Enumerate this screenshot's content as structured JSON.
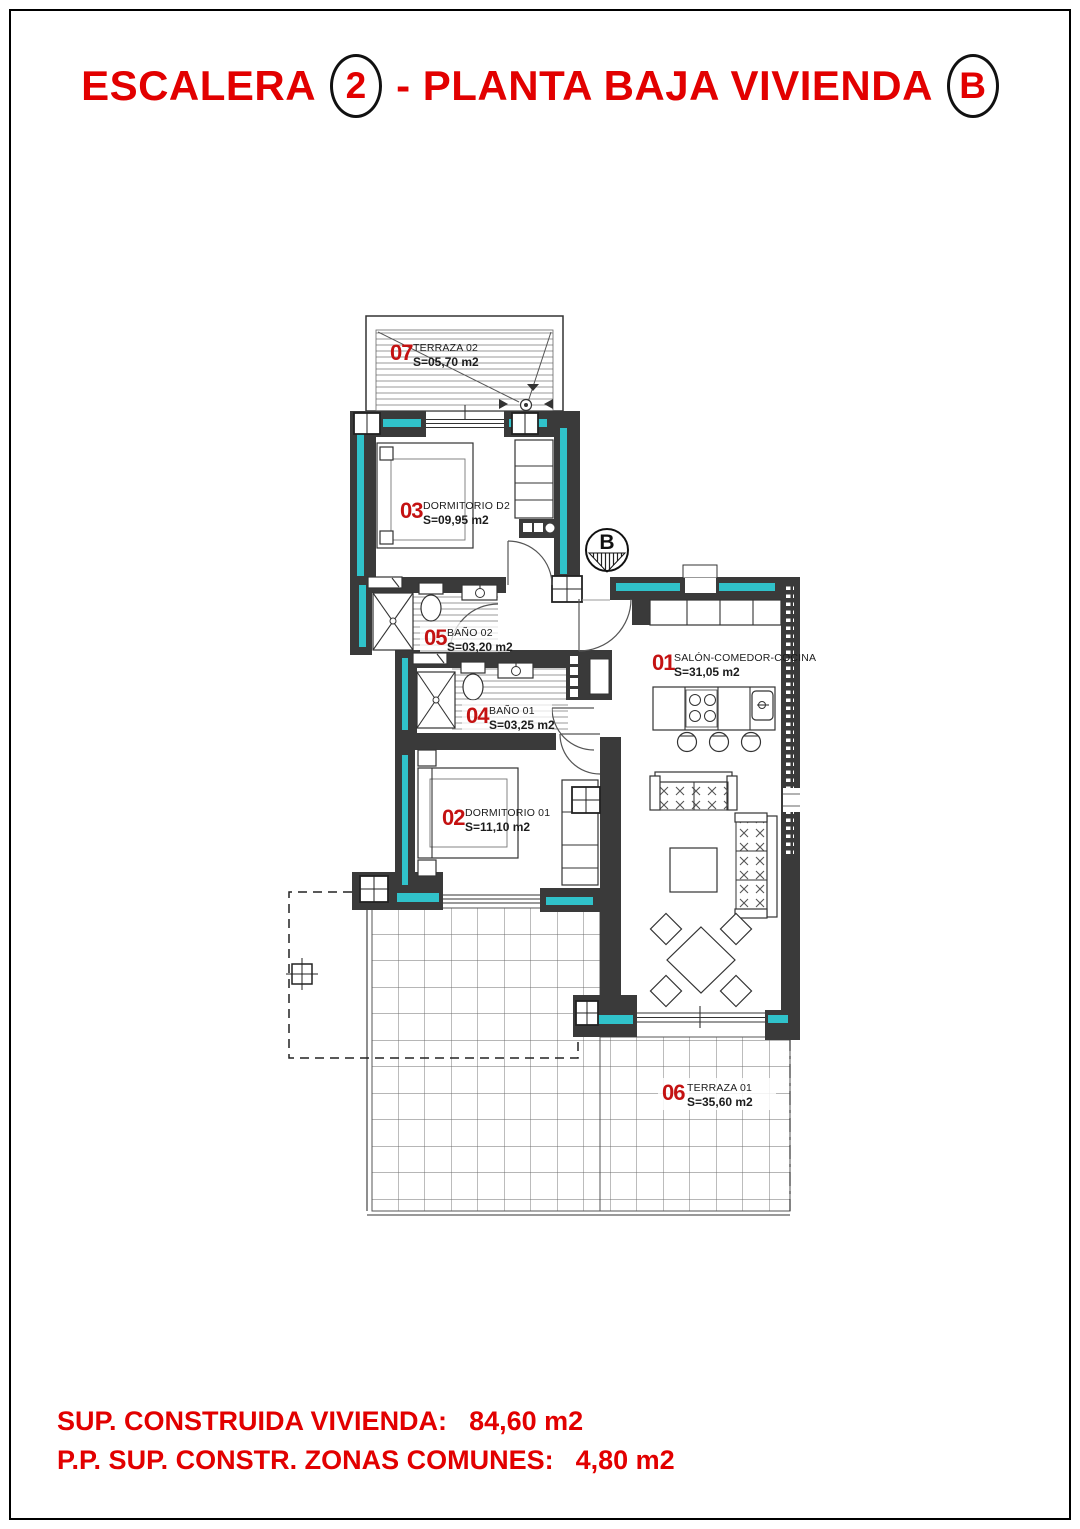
{
  "title": {
    "word1": "ESCALERA",
    "badge1": "2",
    "word2": "- PLANTA BAJA VIVIENDA",
    "badge2": "B"
  },
  "entrance": {
    "label": "B"
  },
  "rooms": [
    {
      "number": "07",
      "name": "TERRAZA 02",
      "area": "S=05,70 m2"
    },
    {
      "number": "03",
      "name": "DORMITORIO D2",
      "area": "S=09,95 m2"
    },
    {
      "number": "05",
      "name": "BAÑO 02",
      "area": "S=03,20 m2"
    },
    {
      "number": "04",
      "name": "BAÑO 01",
      "area": "S=03,25 m2"
    },
    {
      "number": "02",
      "name": "DORMITORIO 01",
      "area": "S=11,10 m2"
    },
    {
      "number": "01",
      "name": "SALÓN-COMEDOR-COCINA",
      "area": "S=31,05 m2"
    },
    {
      "number": "06",
      "name": "TERRAZA 01",
      "area": "S=35,60 m2"
    }
  ],
  "footer": {
    "line1_label": "SUP. CONSTRUIDA VIVIENDA:",
    "line1_value": "84,60 m2",
    "line2_label": "P.P. SUP. CONSTR. ZONAS COMUNES:",
    "line2_value": "4,80 m2"
  },
  "colors": {
    "title_red": "#e20000",
    "label_red": "#c41212",
    "wall_gray": "#3a3a3a",
    "insulation_teal": "#30c2ca"
  }
}
